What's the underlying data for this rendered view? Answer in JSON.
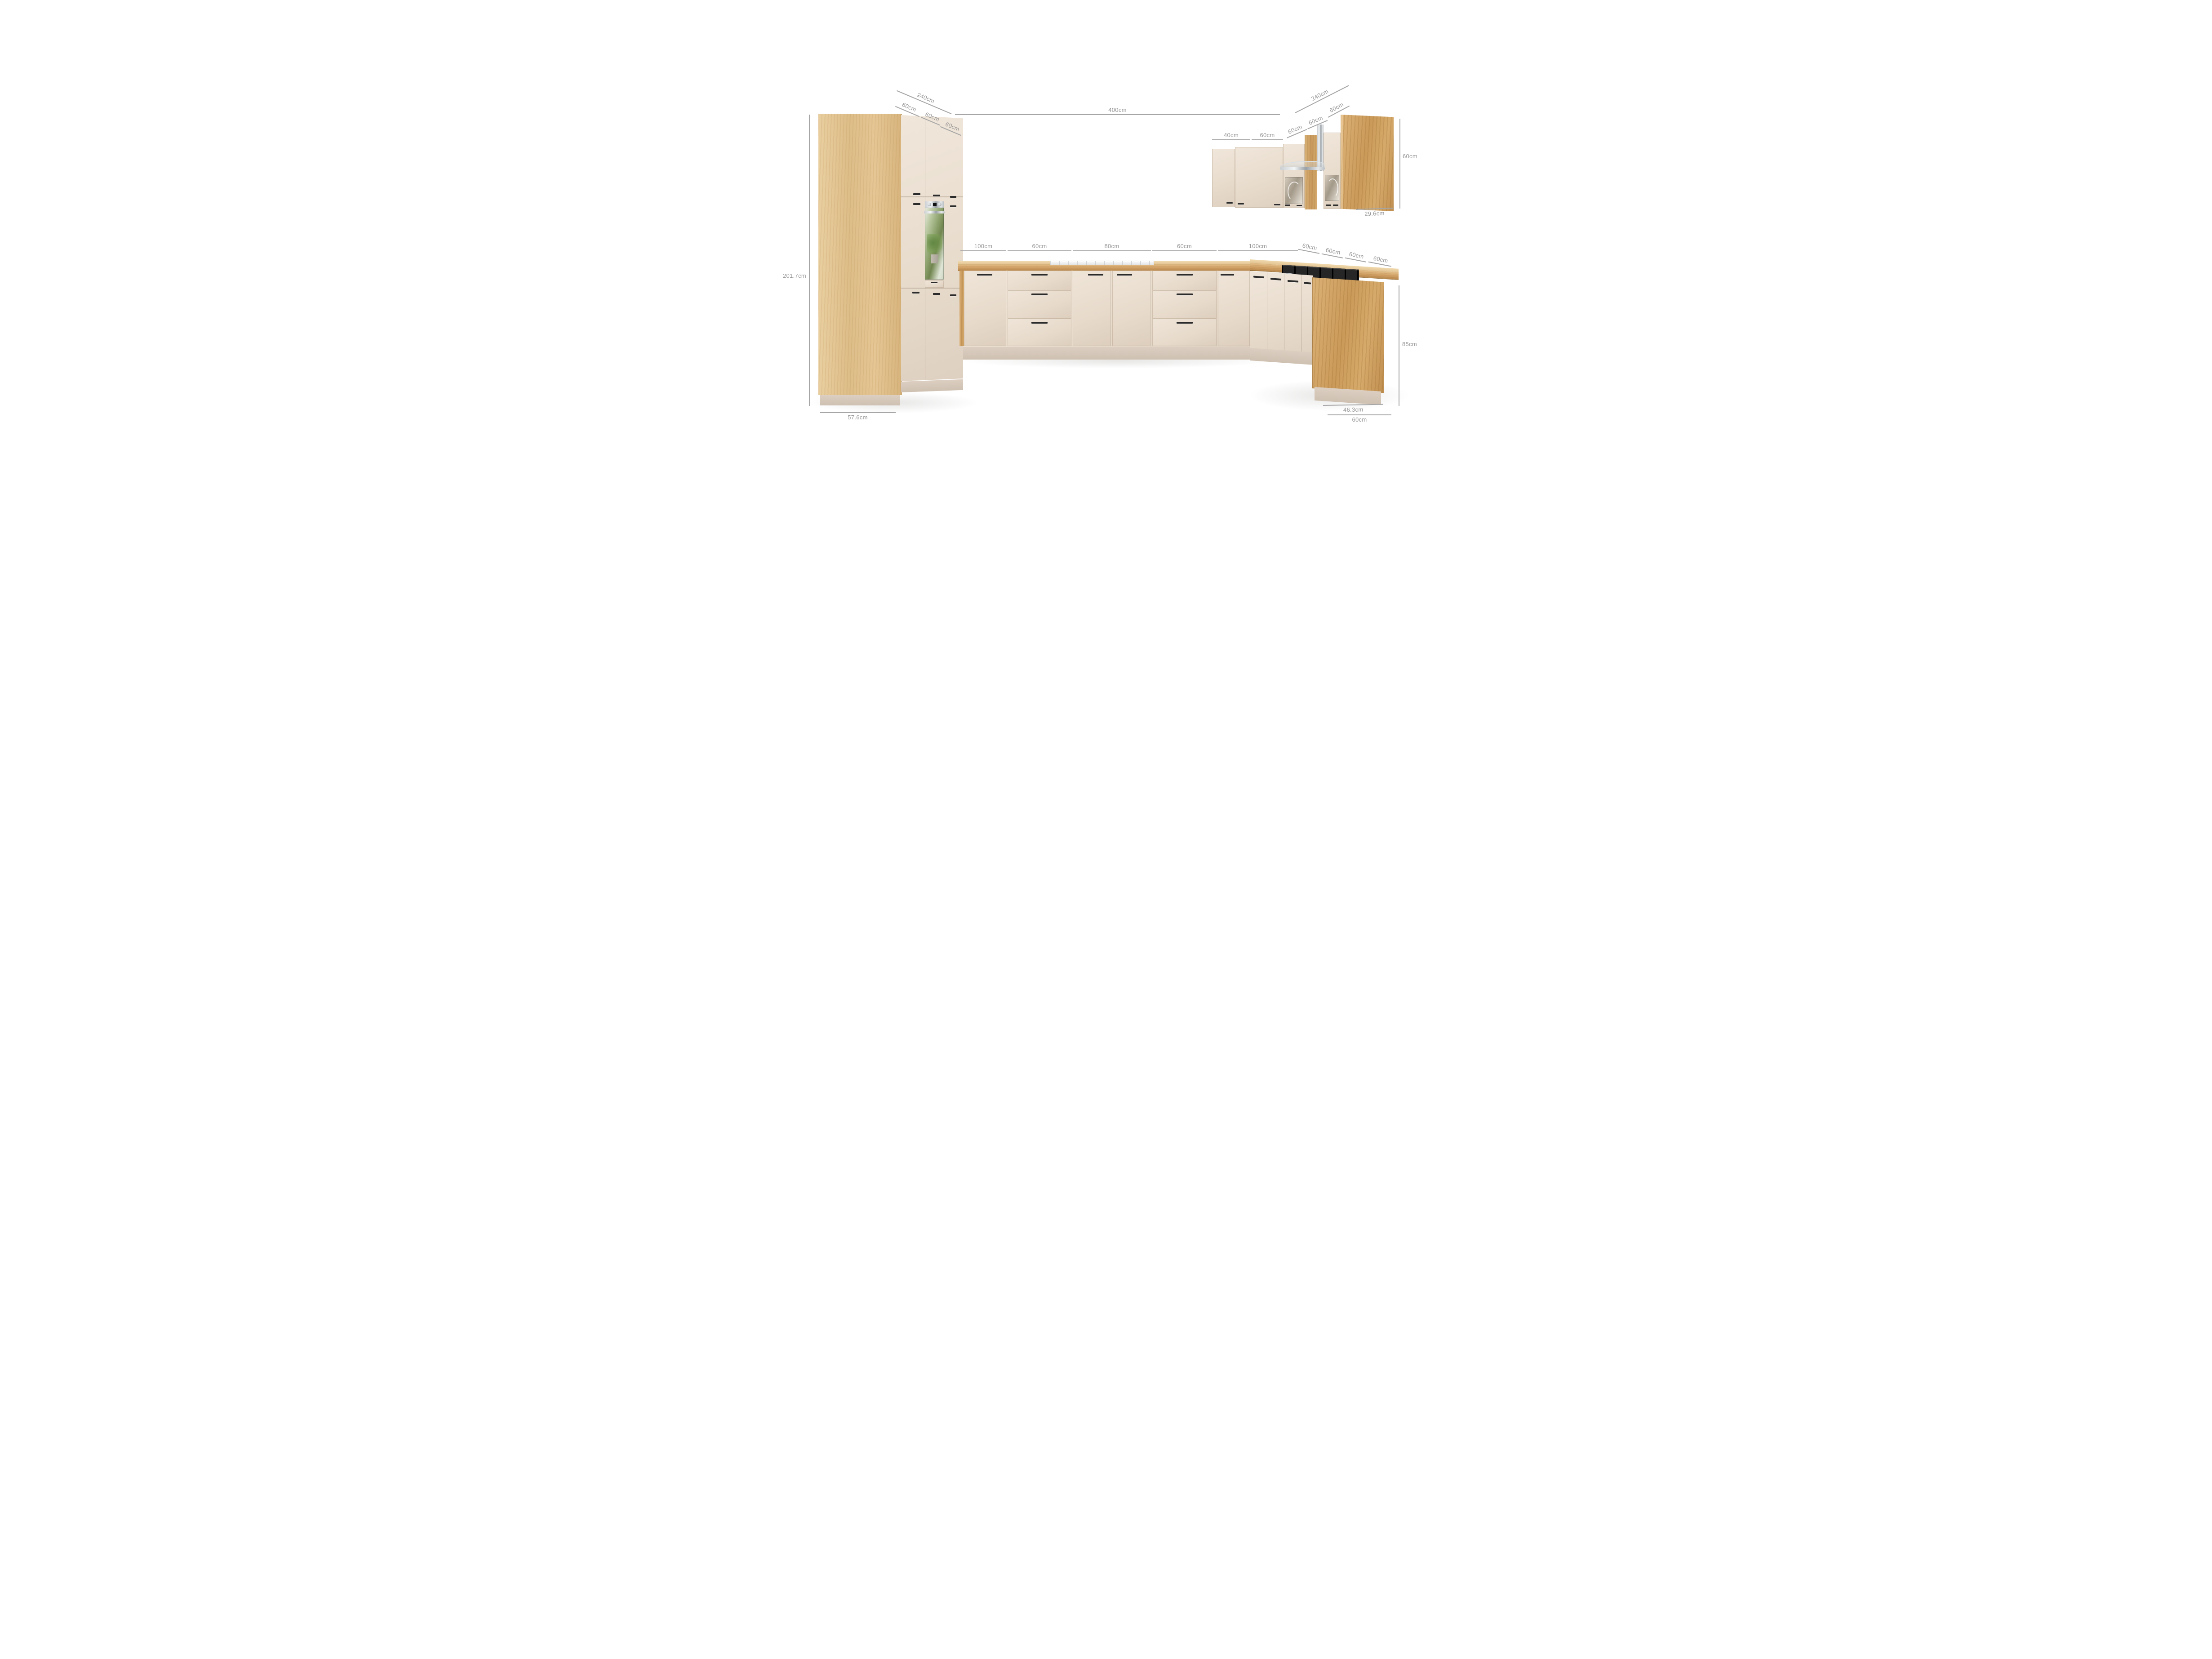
{
  "diagram": {
    "type": "kitchen-furniture-dimension-render",
    "unit": "cm",
    "colors": {
      "front_cream": "#e9ddcf",
      "wood_light": "#e2c18c",
      "wood_counter": "#cf9f63",
      "wood_dark": "#c99757",
      "plinth": "#d6c8ba",
      "dimension_line": "#a6a6a6",
      "dimension_text": "#949494",
      "handle": "#2b2b2b",
      "hob": "#151515"
    },
    "dims": {
      "left_run_top_total": "240cm",
      "left_run_top_seg1": "60cm",
      "left_run_top_seg2": "60cm",
      "left_run_top_seg3": "60cm",
      "front_run_total": "400cm",
      "right_run_top_total": "240cm",
      "right_run_top_seg": "60cm",
      "wall_cab_40": "40cm",
      "wall_cab_60": "60cm",
      "wall_cab_diag1": "60cm",
      "wall_cab_diag2": "60cm",
      "wall_cab_height": "60cm",
      "wall_cab_depth": "29.6cm",
      "base_seg_100a": "100cm",
      "base_seg_60a": "60cm",
      "base_seg_80": "80cm",
      "base_seg_60b": "60cm",
      "base_seg_100b": "100cm",
      "right_base_seg1": "60cm",
      "right_base_seg2": "60cm",
      "right_base_seg3": "60cm",
      "right_base_seg4": "60cm",
      "tall_unit_height": "201.7cm",
      "tall_unit_depth": "57.6cm",
      "base_height": "85cm",
      "peninsula_panel_depth": "46.3cm",
      "peninsula_depth": "60cm"
    }
  }
}
